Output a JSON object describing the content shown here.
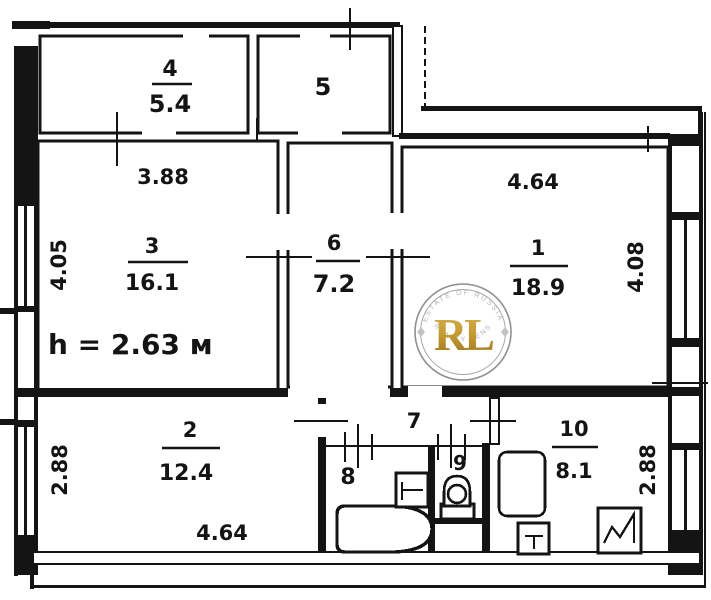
{
  "plan": {
    "height_note": "h = 2.63 м",
    "rooms": {
      "r1": {
        "number": "1",
        "area": "18.9",
        "dim_top": "4.64",
        "dim_right": "4.08"
      },
      "r2": {
        "number": "2",
        "area": "12.4",
        "dim_left": "2.88",
        "dim_bottom": "4.64"
      },
      "r3": {
        "number": "3",
        "area": "16.1",
        "dim_top": "3.88",
        "dim_left": "4.05"
      },
      "r4": {
        "number": "4",
        "area": "5.4"
      },
      "r5": {
        "number": "5"
      },
      "r6": {
        "number": "6",
        "area": "7.2"
      },
      "r7": {
        "number": "7"
      },
      "r8": {
        "number": "8"
      },
      "r9": {
        "number": "9"
      },
      "r10": {
        "number": "10",
        "area": "8.1",
        "dim_right": "2.88"
      }
    },
    "watermark": {
      "monogram": "RL",
      "arc_top": "ESTATE OF RUSSIA",
      "arc_bottom": "REALTY LENS",
      "gold": "#c49a33"
    },
    "colors": {
      "ink": "#141414",
      "paper": "#ffffff"
    }
  }
}
